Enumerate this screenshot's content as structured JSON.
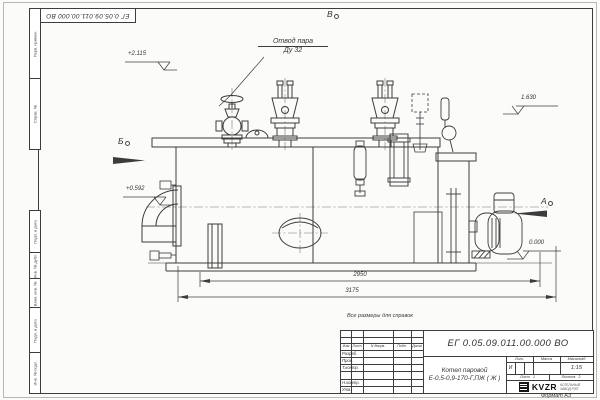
{
  "sheet": {
    "doc_number": "ЕГ 0.05.09.011.00.000  ВО",
    "format_label": "Формат А3",
    "margin_labels": [
      "Перв. примен.",
      "Справ. №",
      "Подп. и дата",
      "Инв. № дубл.",
      "Взам. инв. №",
      "Подп. и дата",
      "Инв. № подл."
    ]
  },
  "drawing": {
    "leader_steam_outlet": {
      "line1": "Отвод пара",
      "line2": "Ду 32"
    },
    "elevation_marks": [
      {
        "label": "+2.115"
      },
      {
        "label": "1.630"
      },
      {
        "label": "+0.592"
      },
      {
        "label": "0.000"
      }
    ],
    "view_labels": {
      "top": "В",
      "left": "Б",
      "right": "А"
    },
    "dimensions": [
      {
        "value": "2950"
      },
      {
        "value": "3175"
      }
    ],
    "note": "Все размеры для справок"
  },
  "title_block": {
    "designation": "ЕГ 0.05.09.011.00.000  ВО",
    "product_name_line1": "Котел паровой",
    "product_name_line2": "Е-0,5-0,9-170-Г,ПЖ ( Ж )",
    "revision_header": {
      "izm": "Изм",
      "list": "Лист",
      "doc": "N докум.",
      "sign": "Подп.",
      "date": "Дата"
    },
    "signature_rows": [
      {
        "label": "Разраб."
      },
      {
        "label": "Пров."
      },
      {
        "label": "Т.контр."
      },
      {
        "label": ""
      },
      {
        "label": "Н.контр."
      },
      {
        "label": "Утв."
      }
    ],
    "lit_header": "Лит.",
    "mass_header": "Масса",
    "scale_header": "Масштаб",
    "lit_value": "И",
    "scale_value": "1:15",
    "sheet_label": "Лист",
    "sheet_value": "1",
    "sheets_label": "Листов",
    "sheets_value": "2",
    "company": {
      "logo": "KVZR",
      "sub_line1": "КОТЕЛЬНЫЙ",
      "sub_line2": "ЗАВОД РЭП"
    }
  }
}
